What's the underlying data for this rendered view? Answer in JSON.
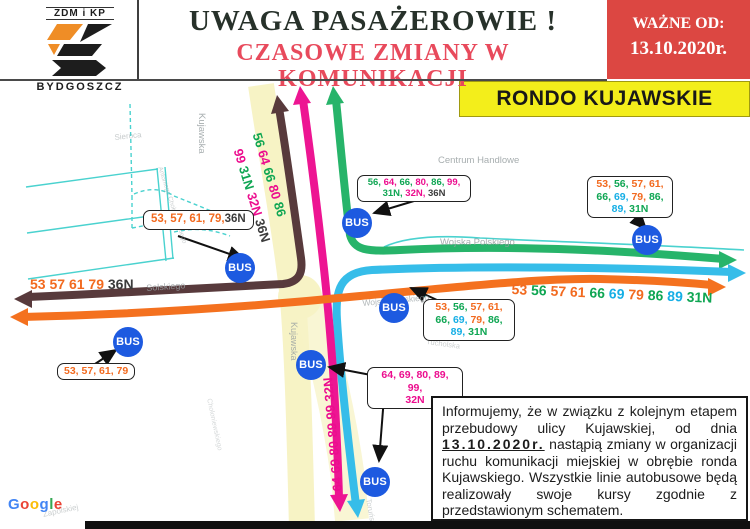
{
  "colors": {
    "o": "#f26a1f",
    "g": "#0fa653",
    "c": "#15aee5",
    "m": "#ec0d8e",
    "k": "#3b3b3b",
    "route_green": "#27b46a",
    "route_cyan": "#36bde9",
    "route_magenta": "#ed1592",
    "route_dark": "#583a3c",
    "route_orange": "#f4711f",
    "road_yellow": "#f7f3c5",
    "street_cyan": "#4ad2cf",
    "bus_blue": "#1d5ae0",
    "gray_street": "#98a0a2",
    "red_box": "#dc4742",
    "banner_yellow": "#f3ee1b",
    "title": "#27312a",
    "subtitle": "#e84a5c",
    "logo_orange": "#ef8d26",
    "logo_black": "#1d1d1d",
    "gg_blue": "#4285f4",
    "gg_red": "#ea4335",
    "gg_yellow": "#fbbc05",
    "gg_green": "#34a853"
  },
  "header": {
    "logo_top": "ZDM i KP",
    "logo_city": "BYDGOSZCZ",
    "title": "UWAGA PASAŻEROWIE !",
    "subtitle": "CZASOWE ZMIANY W KOMUNIKACJI",
    "valid_from_label": "WAŻNE OD:",
    "valid_from_date": "13.10.2020r.",
    "location_banner": "RONDO KUJAWSKIE"
  },
  "map": {
    "bus_stop_text": "BUS",
    "streets": {
      "kujawska": "Kujawska",
      "kujawska2": "Kujawska",
      "sieroca": "Sieroca",
      "choloniewskiego": "Antoniego Chołoniewskiego",
      "choloniewskiego2": "Chołoniewskiego",
      "solskiego": "Solskiego",
      "wojska_polskiego": "Wojska Polskiego",
      "wojska_polskiego2": "Wojska Polskiego",
      "tucholska": "Tucholska",
      "torunska": "Toruńska",
      "zapolskiej": "Zapolskiej"
    },
    "places": {
      "shopping_center": "Centrum Handlowe"
    },
    "route_texts": {
      "top_a": [
        {
          "t": "56 ",
          "c": "g"
        },
        {
          "t": "64 ",
          "c": "m"
        },
        {
          "t": "66 ",
          "c": "g"
        },
        {
          "t": "80 ",
          "c": "m"
        },
        {
          "t": "86",
          "c": "g"
        }
      ],
      "top_b": [
        {
          "t": "99 ",
          "c": "m"
        },
        {
          "t": "31N ",
          "c": "g"
        },
        {
          "t": "32N ",
          "c": "m"
        },
        {
          "t": "36N",
          "c": "k"
        }
      ],
      "west": [
        {
          "t": "53 ",
          "c": "o"
        },
        {
          "t": "57 ",
          "c": "o"
        },
        {
          "t": "61 ",
          "c": "o"
        },
        {
          "t": "79 ",
          "c": "o"
        },
        {
          "t": "36N",
          "c": "k"
        }
      ],
      "east": [
        {
          "t": "53 ",
          "c": "o"
        },
        {
          "t": "56 ",
          "c": "g"
        },
        {
          "t": "57 ",
          "c": "o"
        },
        {
          "t": "61 ",
          "c": "o"
        },
        {
          "t": "66 ",
          "c": "g"
        },
        {
          "t": "69 ",
          "c": "c"
        },
        {
          "t": "79 ",
          "c": "o"
        },
        {
          "t": "86 ",
          "c": "g"
        },
        {
          "t": "89 ",
          "c": "c"
        },
        {
          "t": "31N",
          "c": "g"
        }
      ],
      "south": [
        {
          "t": "64 69 80 89 99 32N",
          "c": "m"
        }
      ]
    },
    "stop_labels": {
      "west": [
        [
          {
            "t": "53, ",
            "c": "o"
          },
          {
            "t": "57, ",
            "c": "o"
          },
          {
            "t": "61, ",
            "c": "o"
          },
          {
            "t": "79,",
            "c": "o"
          },
          {
            "t": "36N",
            "c": "k"
          }
        ]
      ],
      "north": [
        [
          {
            "t": "56, ",
            "c": "g"
          },
          {
            "t": "64, ",
            "c": "m"
          },
          {
            "t": "66, ",
            "c": "g"
          },
          {
            "t": "80, ",
            "c": "m"
          },
          {
            "t": "86, ",
            "c": "g"
          },
          {
            "t": "99,",
            "c": "m"
          }
        ],
        [
          {
            "t": "31N, ",
            "c": "g"
          },
          {
            "t": "32N, ",
            "c": "m"
          },
          {
            "t": "36N",
            "c": "k"
          }
        ]
      ],
      "east": [
        [
          {
            "t": "53, ",
            "c": "o"
          },
          {
            "t": "56, ",
            "c": "g"
          },
          {
            "t": "57, ",
            "c": "o"
          },
          {
            "t": "61,",
            "c": "o"
          }
        ],
        [
          {
            "t": "66, ",
            "c": "g"
          },
          {
            "t": "69, ",
            "c": "c"
          },
          {
            "t": "79, ",
            "c": "o"
          },
          {
            "t": "86,",
            "c": "g"
          }
        ],
        [
          {
            "t": "89, ",
            "c": "c"
          },
          {
            "t": "31N",
            "c": "g"
          }
        ]
      ],
      "center": [
        [
          {
            "t": "53, ",
            "c": "o"
          },
          {
            "t": "56, ",
            "c": "g"
          },
          {
            "t": "57, ",
            "c": "o"
          },
          {
            "t": "61,",
            "c": "o"
          }
        ],
        [
          {
            "t": "66, ",
            "c": "g"
          },
          {
            "t": "69, ",
            "c": "c"
          },
          {
            "t": "79, ",
            "c": "o"
          },
          {
            "t": "86,",
            "c": "g"
          }
        ],
        [
          {
            "t": "89, ",
            "c": "c"
          },
          {
            "t": "31N",
            "c": "g"
          }
        ]
      ],
      "southwest": [
        [
          {
            "t": "53, 57, 61, 79",
            "c": "o"
          }
        ]
      ],
      "south": [
        [
          {
            "t": "64, 69, 80, 89, 99,",
            "c": "m"
          }
        ],
        [
          {
            "t": "32N",
            "c": "m"
          }
        ]
      ]
    }
  },
  "notice": {
    "part1": "Informujemy, że w związku z kolejnym etapem przebudowy ulicy Kujawskiej, od dnia",
    "date": "13.10.2020r.",
    "part2": "nastąpią zmiany w organizacji ruchu komunikacji miejskiej w obrębie ronda Kujawskiego. Wszystkie linie autobusowe będą realizowały swoje kursy zgodnie z przedstawionym schematem."
  },
  "watermark_tokens": [
    {
      "t": "G",
      "c": "gg_blue"
    },
    {
      "t": "o",
      "c": "gg_red"
    },
    {
      "t": "o",
      "c": "gg_yellow"
    },
    {
      "t": "g",
      "c": "gg_blue"
    },
    {
      "t": "l",
      "c": "gg_green"
    },
    {
      "t": "e",
      "c": "gg_red"
    }
  ]
}
